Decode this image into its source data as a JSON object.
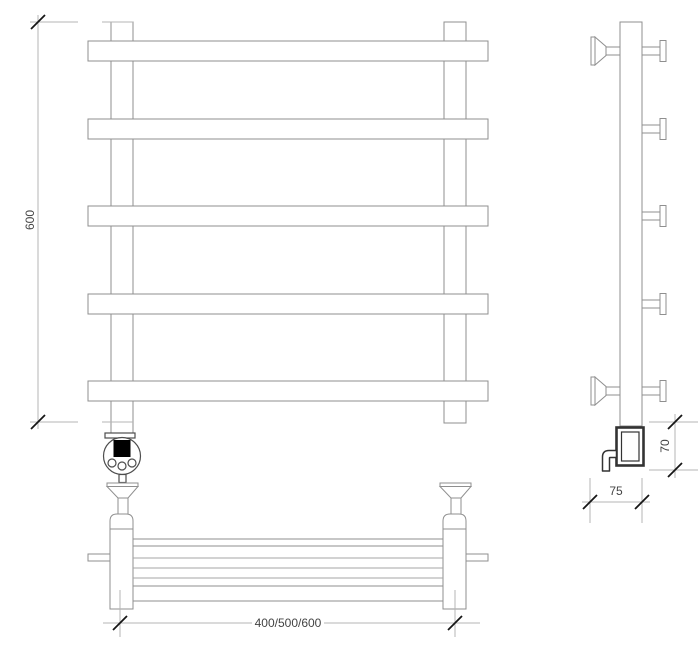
{
  "drawing": {
    "subject": "heated-towel-rail-ladder-with-shelf-technical-drawing",
    "views": [
      "front",
      "side",
      "plan"
    ],
    "parts": {
      "towel_bars_count": 5,
      "wall_brackets_count": 2,
      "controller_buttons_count": 3
    },
    "dimensions": {
      "height": {
        "label": "600"
      },
      "width": {
        "label": "400/500/600"
      },
      "heater_height": {
        "label": "70"
      },
      "bracket_depth": {
        "label": "75"
      }
    },
    "colors": {
      "background": "#ffffff",
      "outline": "#8f8f8f",
      "dimension_line": "#b5b5b5",
      "tick": "#161616",
      "text": "#444444",
      "heater_outline": "#333333",
      "controller_display": "#000000"
    }
  }
}
